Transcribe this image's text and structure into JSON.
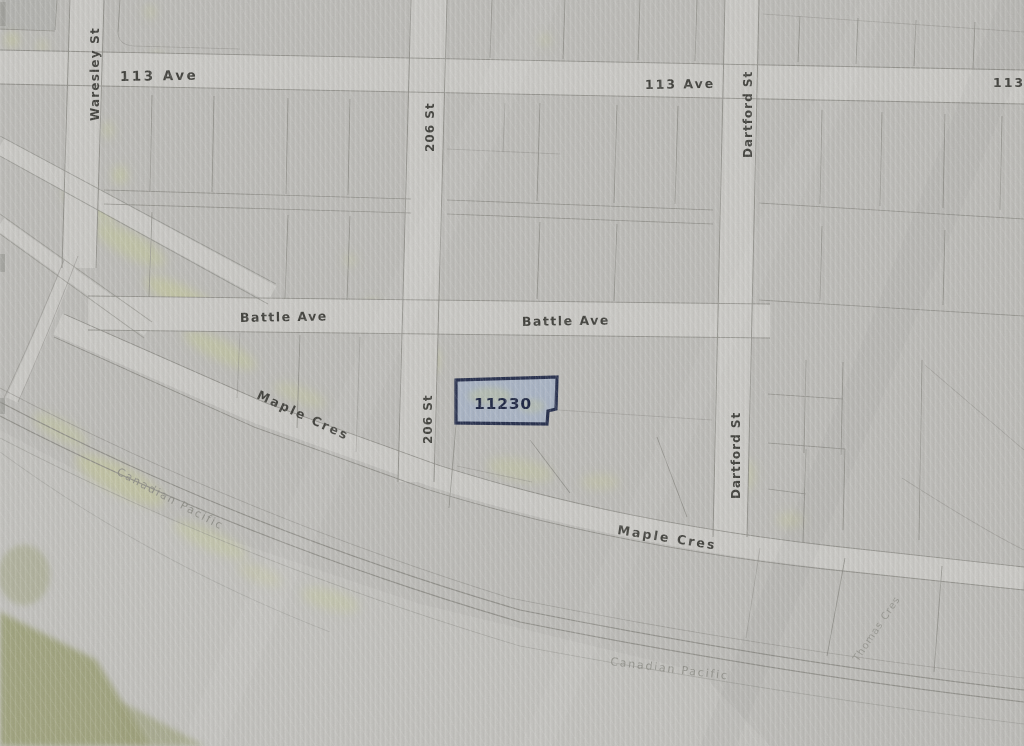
{
  "map": {
    "type": "plat-map-photo",
    "subject_parcel": {
      "number": "11230",
      "fill": "#a7b2c3",
      "border": "#1e2746",
      "number_color": "#141d3b"
    },
    "street_labels": {
      "ave_113_left": "113 Ave",
      "ave_113_mid": "113 Ave",
      "ave_113_right_partial": "113",
      "waresley_st": "Waresley St",
      "st_206_upper": "206 St",
      "st_206_lower": "206 St",
      "dartford_st_upper": "Dartford St",
      "dartford_st_lower": "Dartford St",
      "battle_ave_left": "Battle Ave",
      "battle_ave_mid": "Battle Ave",
      "maple_cres_left": "Maple Cres",
      "maple_cres_right": "Maple Cres",
      "thomas_cres": "Thomas Cres"
    },
    "railway_labels": {
      "canadian_pacific_left": "Canadian Pacific",
      "canadian_pacific_bottom": "Canadian Pacific"
    },
    "colors": {
      "paper": "#bbbab6",
      "road": "#c9c8c4",
      "open_area": "#c6c5c1",
      "boundary_line": "#85847e",
      "street_label": "#3a3a35",
      "faint_label": "#8a8a83",
      "vegetation": "#c6ca90",
      "vegetation_dark": "#9a9d74"
    }
  }
}
